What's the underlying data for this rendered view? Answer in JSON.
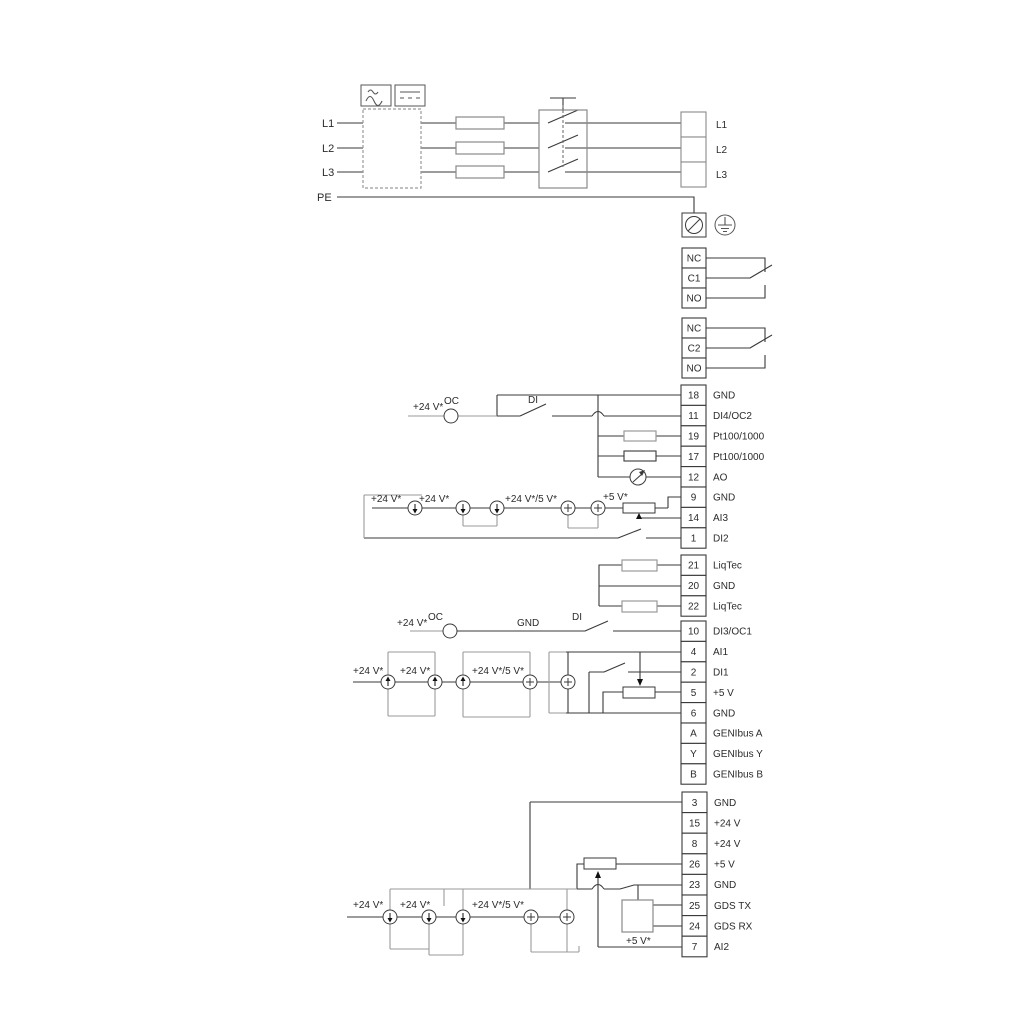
{
  "power": {
    "l1": "L1",
    "l2": "L2",
    "l3": "L3",
    "pe": "PE"
  },
  "tb_power": {
    "labels": [
      "L1",
      "L2",
      "L3"
    ]
  },
  "relay1": {
    "labels": [
      "NC",
      "C1",
      "NO"
    ]
  },
  "relay2": {
    "labels": [
      "NC",
      "C2",
      "NO"
    ]
  },
  "io1": {
    "numbers": [
      "18",
      "11",
      "19",
      "17",
      "12",
      "9",
      "14",
      "1"
    ],
    "labels": [
      "GND",
      "DI4/OC2",
      "Pt100/1000",
      "Pt100/1000",
      "AO",
      "GND",
      "AI3",
      "DI2"
    ]
  },
  "liqtec": {
    "numbers": [
      "21",
      "20",
      "22"
    ],
    "labels": [
      "LiqTec",
      "GND",
      "LiqTec"
    ]
  },
  "io2": {
    "numbers": [
      "10",
      "4",
      "2",
      "5",
      "6",
      "A",
      "Y",
      "B"
    ],
    "labels": [
      "DI3/OC1",
      "AI1",
      "DI1",
      "+5 V",
      "GND",
      "GENIbus A",
      "GENIbus Y",
      "GENIbus B"
    ]
  },
  "io3": {
    "numbers": [
      "3",
      "15",
      "8",
      "26",
      "23",
      "25",
      "24",
      "7"
    ],
    "labels": [
      "GND",
      "+24 V",
      "+24 V",
      "+5 V",
      "GND",
      "GDS TX",
      "GDS RX",
      "AI2"
    ]
  },
  "annotations": {
    "v24": "+24 V*",
    "v24_5": "+24 V*/5 V*",
    "v5": "+5 V*",
    "oc": "OC",
    "di": "DI",
    "gnd": "GND"
  },
  "colors": {
    "wire": "#3a3a3a",
    "alt_wire": "#9a9a9a",
    "background": "#ffffff"
  }
}
